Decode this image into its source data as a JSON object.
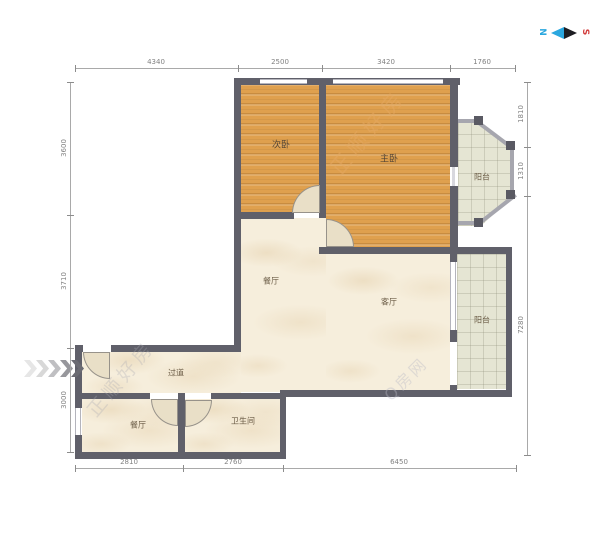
{
  "compass": {
    "north": "N",
    "south": "S"
  },
  "watermarks": {
    "primary": "正顺好房",
    "secondary": "正顺好房",
    "tertiary": "Q房网"
  },
  "rooms": {
    "second_bedroom": "次卧",
    "master_bedroom": "主卧",
    "balcony_top": "阳台",
    "balcony_right": "阳台",
    "dining": "餐厅",
    "living": "客厅",
    "hallway": "过道",
    "kitchen": "餐厅",
    "bathroom": "卫生间"
  },
  "dimensions": {
    "top": [
      "4340",
      "2500",
      "3420",
      "1760"
    ],
    "left": [
      "3600",
      "3710",
      "3000"
    ],
    "right": [
      "1810",
      "1310",
      "7280"
    ],
    "bottom": [
      "2810",
      "2760",
      "6450"
    ]
  },
  "colors": {
    "wall": "#60606a",
    "wood_floor": "#dfa04e",
    "marble_floor": "#f6eedc",
    "balcony_tile": "#e5e5d3",
    "north_blue": "#2aa7df",
    "south_red": "#d23c3c"
  }
}
